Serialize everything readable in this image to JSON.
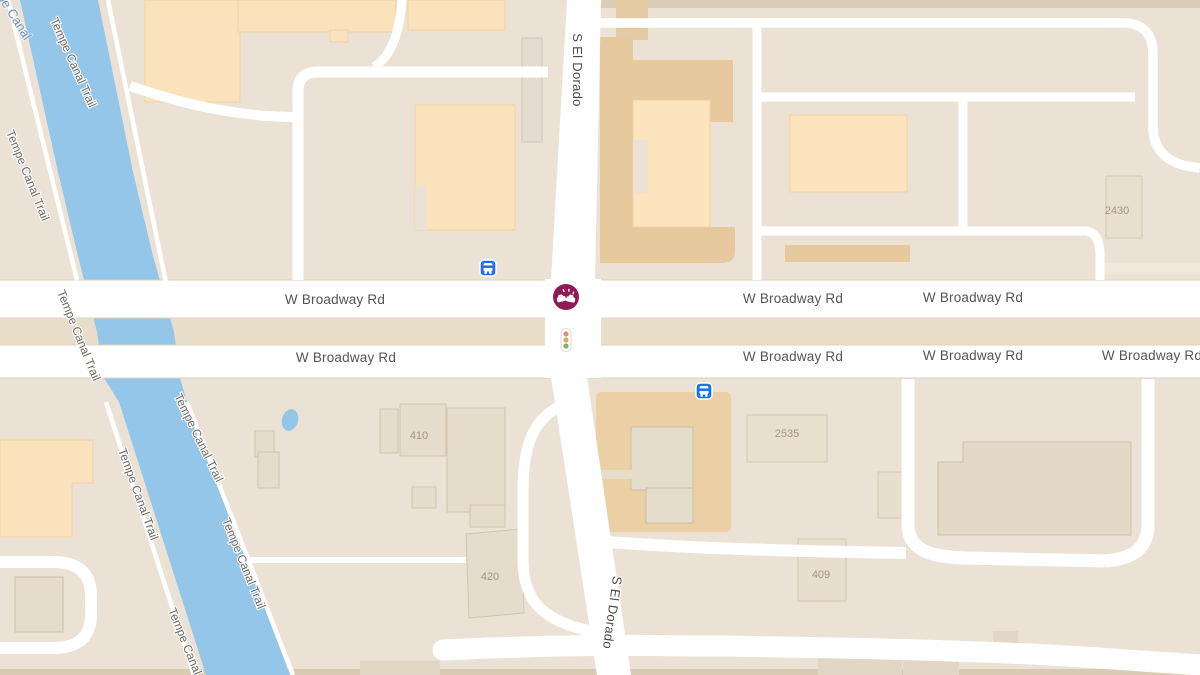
{
  "app": "map-canvas",
  "labels": {
    "broadway": [
      "W Broadway Rd",
      "W Broadway Rd",
      "W Broadway Rd",
      "W Broadway Rd",
      "W Broadway Rd",
      "W Broadway Rd",
      "W Broadway Rd"
    ],
    "el_dorado": [
      "S El Dorado",
      "S El Dorado"
    ],
    "trail": [
      "Tempe Canal Trail",
      "Tempe Canal Trail",
      "Tempe Canal Trail",
      "Tempe Canal Trail",
      "Tempe Canal Trail",
      "Tempe Canal Trail",
      "Tempe Canal Trail"
    ],
    "water": "Tempe Canal",
    "numbers": [
      "2430",
      "2535",
      "410",
      "420",
      "409"
    ]
  },
  "icons": {
    "incident": "car-crash-incident",
    "traffic_signal": "traffic-signal",
    "bus_stops": [
      "bus-stop-nw-corner",
      "bus-stop-se-corner"
    ]
  },
  "colors": {
    "background": "#EBE2D5",
    "water": "#93C6E8",
    "road": "#FFFFFF",
    "building_peach": "#FAE3BC",
    "building_tan": "#E6C99C",
    "building_light": "#E6DCCB",
    "median": "#E9DEC9",
    "incident_badge": "#8F1A56",
    "bus_badge": "#1A73E8",
    "label_gray": "#575450",
    "trail_label_gray": "#6e6a62",
    "water_label_blue": "#6f93bd"
  }
}
